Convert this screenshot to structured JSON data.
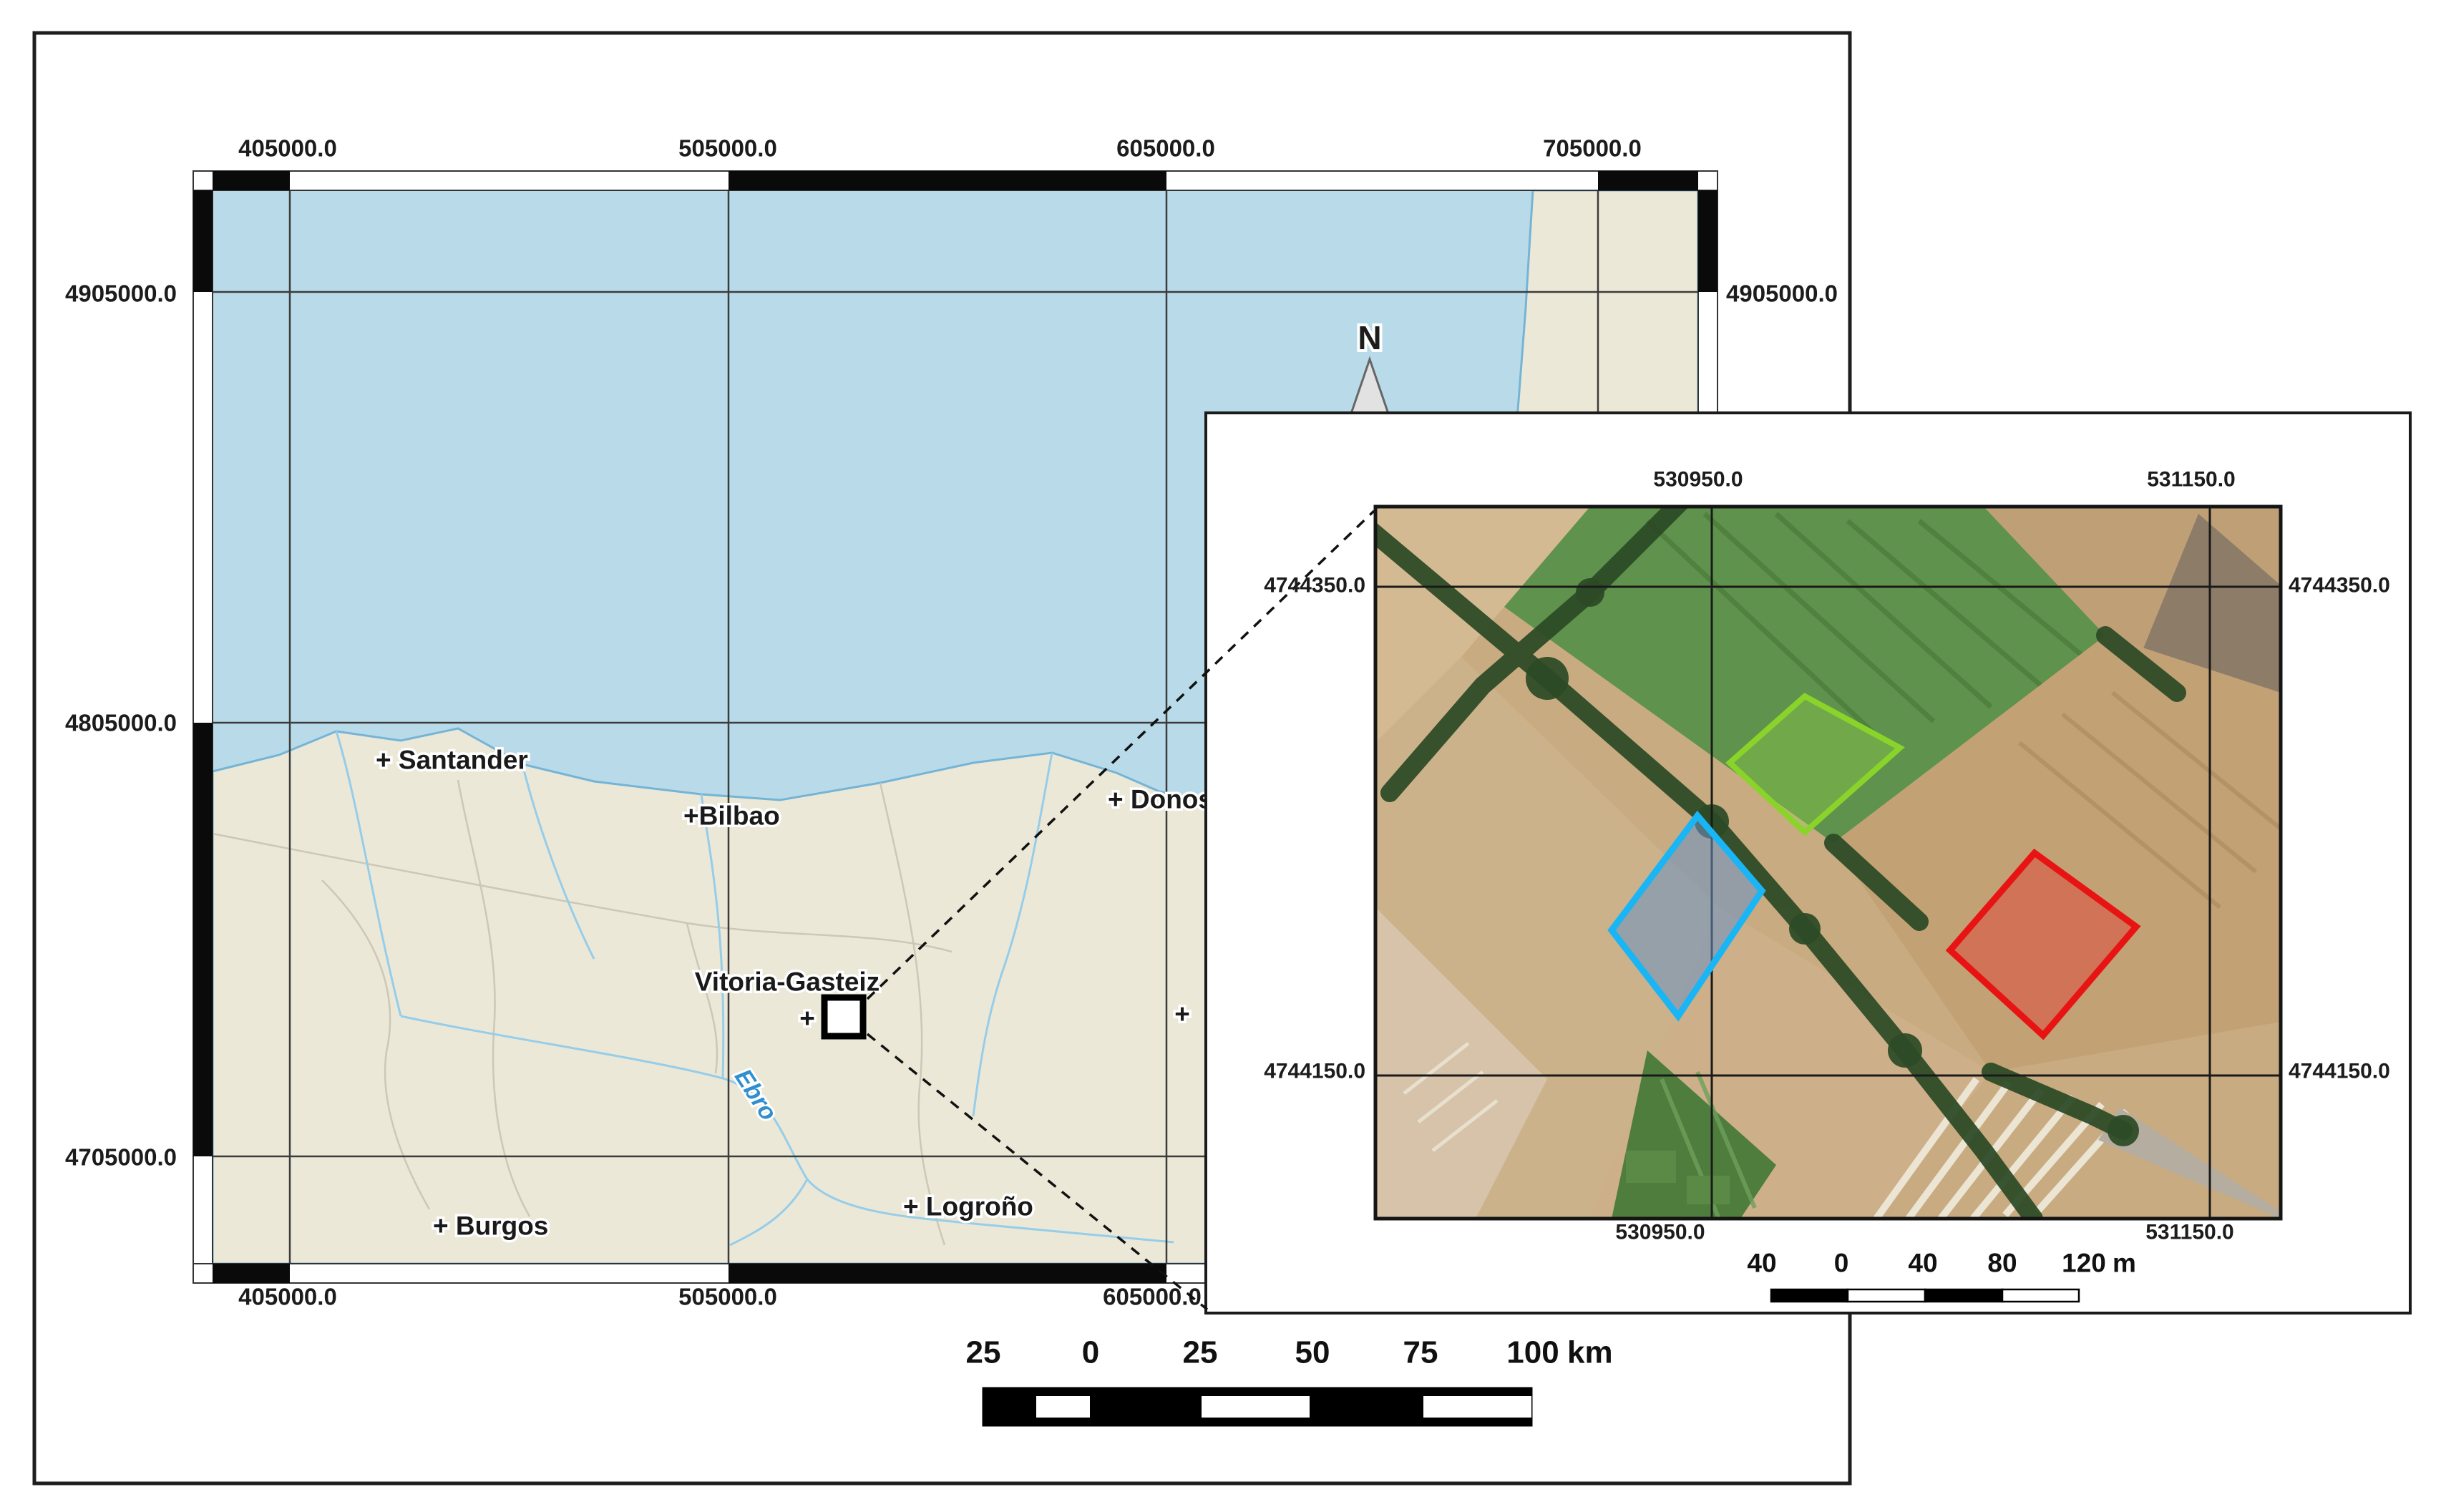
{
  "colors": {
    "sea": "#b9dbe9",
    "land": "#ece8d8",
    "panel": "#ffffff",
    "green_plot": "#8ad32b",
    "blue_plot": "#19b5f5",
    "red_plot": "#e81414"
  },
  "main_map": {
    "top_labels": [
      "405000.0",
      "505000.0",
      "605000.0",
      "705000.0"
    ],
    "bottom_labels": [
      "405000.0",
      "505000.0",
      "605000.0"
    ],
    "left_labels": [
      "4905000.0",
      "4805000.0",
      "4705000.0"
    ],
    "right_labels": [
      "4905000.0"
    ],
    "cities": {
      "santander": "+ Santander",
      "bilbao": "+Bilbao",
      "donostia": "+ Donosti",
      "vitoria": "Vitoria-Gasteiz",
      "burgos": "+ Burgos",
      "logrono": "+ Logroño",
      "hidden_city_cross": "+",
      "marker_cross": "+"
    },
    "river_label": "Ebro",
    "north_label": "N",
    "scalebar_km": {
      "labels": [
        "25",
        "0",
        "25",
        "50",
        "75",
        "100"
      ],
      "unit": "km"
    }
  },
  "inset": {
    "top_labels": [
      "530950.0",
      "531150.0"
    ],
    "bottom_labels": [
      "530950.0",
      "531150.0"
    ],
    "left_labels": [
      "4744350.0",
      "4744150.0"
    ],
    "right_labels": [
      "4744350.0",
      "4744150.0"
    ],
    "scalebar_m": {
      "labels": [
        "40",
        "0",
        "40",
        "80",
        "120"
      ],
      "unit": "m"
    },
    "plots": [
      {
        "name": "green-plot",
        "border_color": "#8ad32b"
      },
      {
        "name": "blue-plot",
        "border_color": "#19b5f5"
      },
      {
        "name": "red-plot",
        "border_color": "#e81414"
      }
    ]
  }
}
